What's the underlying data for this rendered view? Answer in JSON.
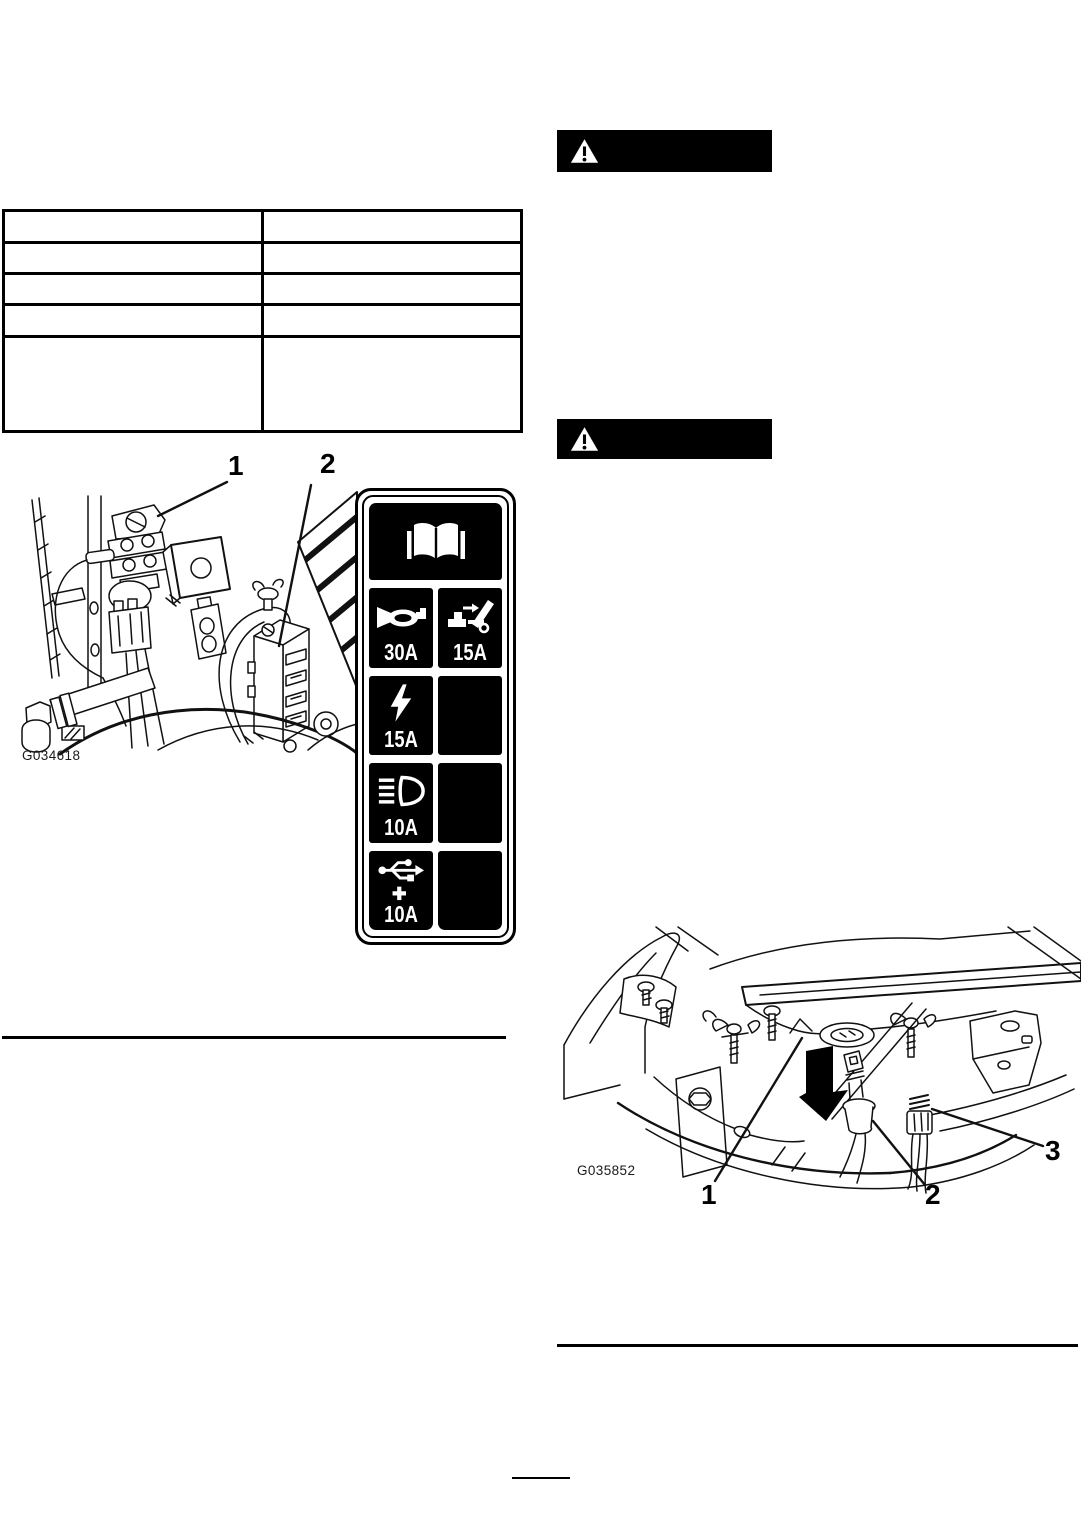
{
  "document": {
    "paper_color": "#ffffff",
    "ink_color": "#000000"
  },
  "spec_table": {
    "columns": 2,
    "rows": 5,
    "cells": [
      [
        "",
        ""
      ],
      [
        "",
        ""
      ],
      [
        "",
        ""
      ],
      [
        "",
        ""
      ],
      [
        "",
        ""
      ]
    ]
  },
  "warning_banners": [
    {
      "icon": "warning-triangle-icon",
      "background": "#000000"
    },
    {
      "icon": "warning-triangle-icon",
      "background": "#000000"
    }
  ],
  "figure_fusebox": {
    "graphic_id": "G034618",
    "callouts": [
      {
        "label": "1"
      },
      {
        "label": "2"
      }
    ]
  },
  "fuse_decal": {
    "header_icon": "operators-manual-icon",
    "fuses": [
      {
        "icon": "horn-icon",
        "amps": "30A"
      },
      {
        "icon": "attachment-dump-icon",
        "amps": "15A"
      },
      {
        "icon": "power-point-icon",
        "amps": "15A"
      },
      {
        "icon": "blank",
        "amps": ""
      },
      {
        "icon": "headlights-icon",
        "amps": "10A"
      },
      {
        "icon": "blank",
        "amps": ""
      },
      {
        "icon": "usb-charge-port-icon",
        "amps": "10A"
      },
      {
        "icon": "blank",
        "amps": ""
      }
    ]
  },
  "figure_headlight": {
    "graphic_id": "G035852",
    "callouts": [
      {
        "label": "1"
      },
      {
        "label": "2"
      },
      {
        "label": "3"
      }
    ]
  }
}
